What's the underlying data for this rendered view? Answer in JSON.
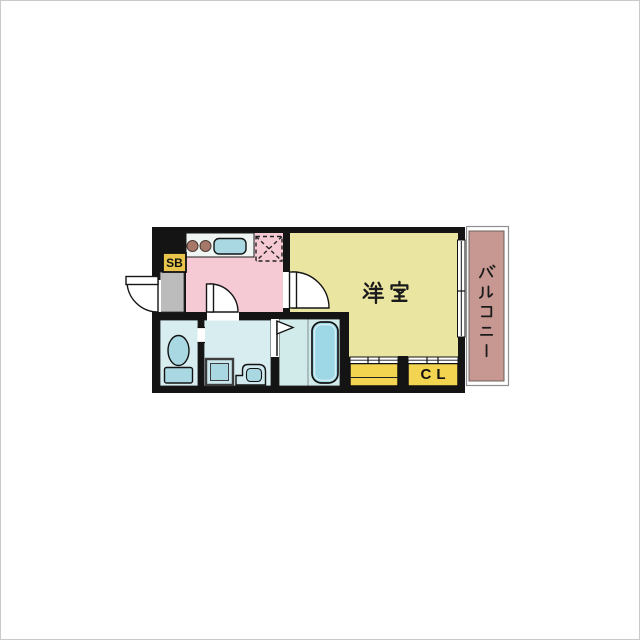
{
  "floor_plan": {
    "labels": {
      "shoe_box": "SB",
      "western_room": "洋室",
      "closet": "CL",
      "balcony": "バルコニー"
    },
    "colors": {
      "wall": "#141414",
      "kitchen_floor": "#f6cad5",
      "western_room_floor": "#ebe5a2",
      "wet_area_floor": "#d7edef",
      "bathroom_floor": "#d1eaea",
      "entrance_floor": "#bcbcbd",
      "closet_fill": "#f2d450",
      "shoe_box_fill": "#e9c64b",
      "balcony_fill": "#c79791",
      "fixture_fill": "#a9d8e2",
      "counter_fill": "#eef5f2",
      "burner_fill": "#a5786a",
      "bathtub_fill": "#9ed7e5"
    },
    "fixtures": [
      "entrance-door",
      "stove-burners",
      "kitchen-sink",
      "refrigerator-space",
      "toilet",
      "washing-machine",
      "washbasin",
      "bathtub",
      "balcony-window",
      "closet-sliding-doors"
    ]
  }
}
